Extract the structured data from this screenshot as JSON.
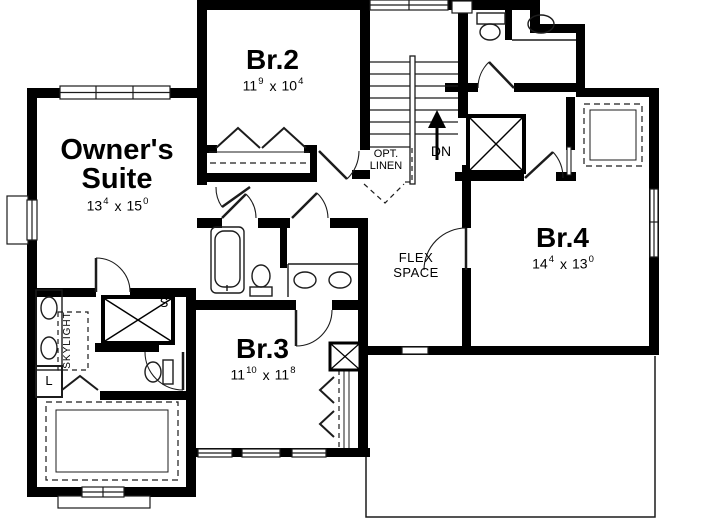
{
  "plan_title": "Second Floor Plan",
  "rooms": {
    "owners_suite": {
      "name_line1": "Owner's",
      "name_line2": "Suite",
      "dims": {
        "ft1": "13",
        "in1": "4",
        "sep": "x",
        "ft2": "15",
        "in2": "0"
      }
    },
    "br2": {
      "name": "Br.2",
      "dims": {
        "ft1": "11",
        "in1": "9",
        "sep": "x",
        "ft2": "10",
        "in2": "4"
      }
    },
    "br3": {
      "name": "Br.3",
      "dims": {
        "ft1": "11",
        "in1": "10",
        "sep": "x",
        "ft2": "11",
        "in2": "8"
      }
    },
    "br4": {
      "name": "Br.4",
      "dims": {
        "ft1": "14",
        "in1": "4",
        "sep": "x",
        "ft2": "13",
        "in2": "0"
      }
    }
  },
  "labels": {
    "flex_line1": "FLEX",
    "flex_line2": "SPACE",
    "opt_linen_line1": "OPT.",
    "opt_linen_line2": "LINEN",
    "down": "DN",
    "skylight": "SKYLIGHT",
    "shower": "S",
    "linen": "L"
  },
  "colors": {
    "wall": "#000000",
    "background": "#ffffff",
    "thin_line": "#1c1c1c"
  }
}
